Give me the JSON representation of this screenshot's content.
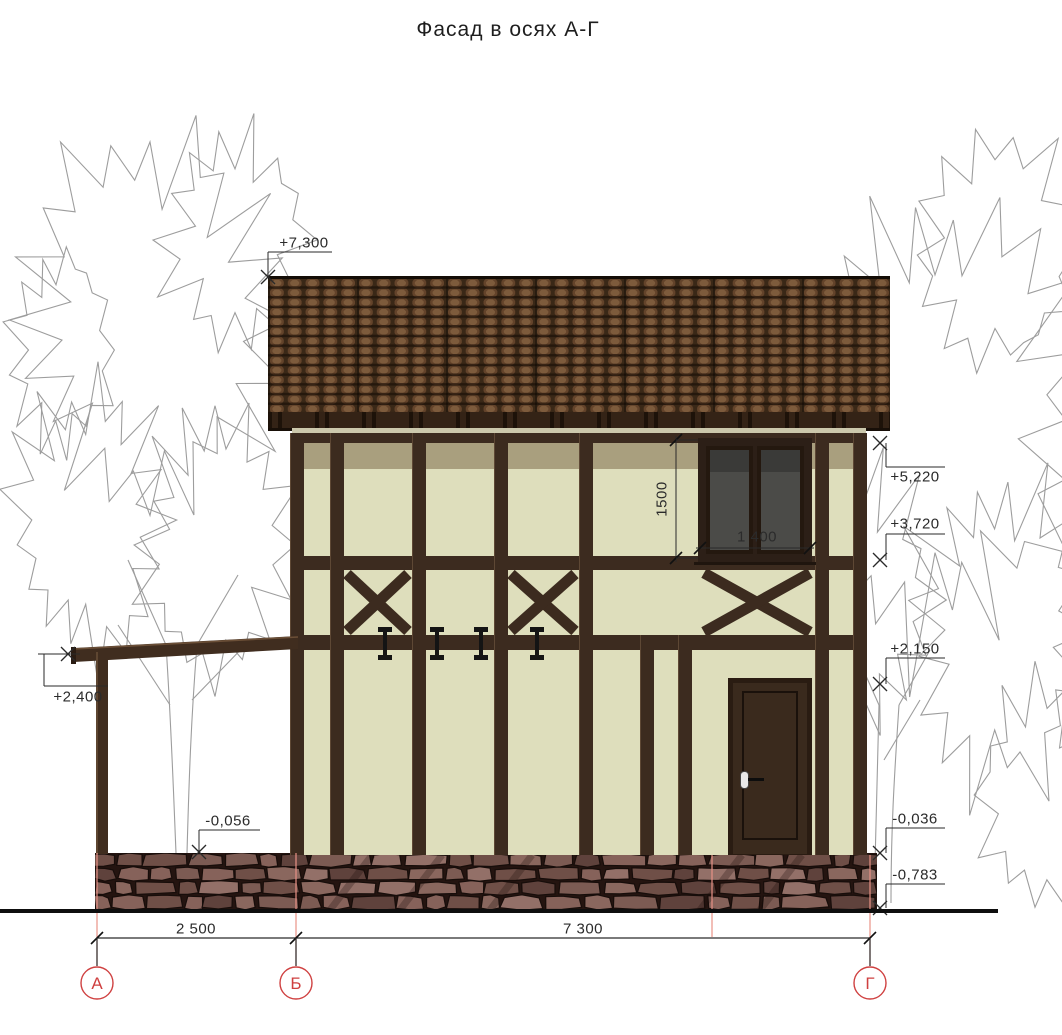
{
  "title": "Фасад в осях А-Г",
  "elevations": {
    "roof_top": "+7,300",
    "eaves": "+5,220",
    "second_floor_sill": "+3,720",
    "door_top": "+2,150",
    "porch_roof": "+2,400",
    "porch_floor": "-0,056",
    "plinth_top": "-0,036",
    "ground": "-0,783"
  },
  "dimensions": {
    "window_height": "1500",
    "window_width": "1 400",
    "span_a_b": "2 500",
    "span_b_g": "7 300"
  },
  "axes": {
    "left": "А",
    "middle": "Б",
    "right": "Г"
  },
  "colors": {
    "wall": "#dedebc",
    "wall_shadow": "#a99f7e",
    "timber": "#3c2b1f",
    "roof_tile": "#7d5b3c",
    "fascia": "#342316",
    "stone": "#7c5b53",
    "glass": "#4b4b48",
    "axis_red": "#cf4040",
    "tree_outline": "#9d9d9d"
  }
}
